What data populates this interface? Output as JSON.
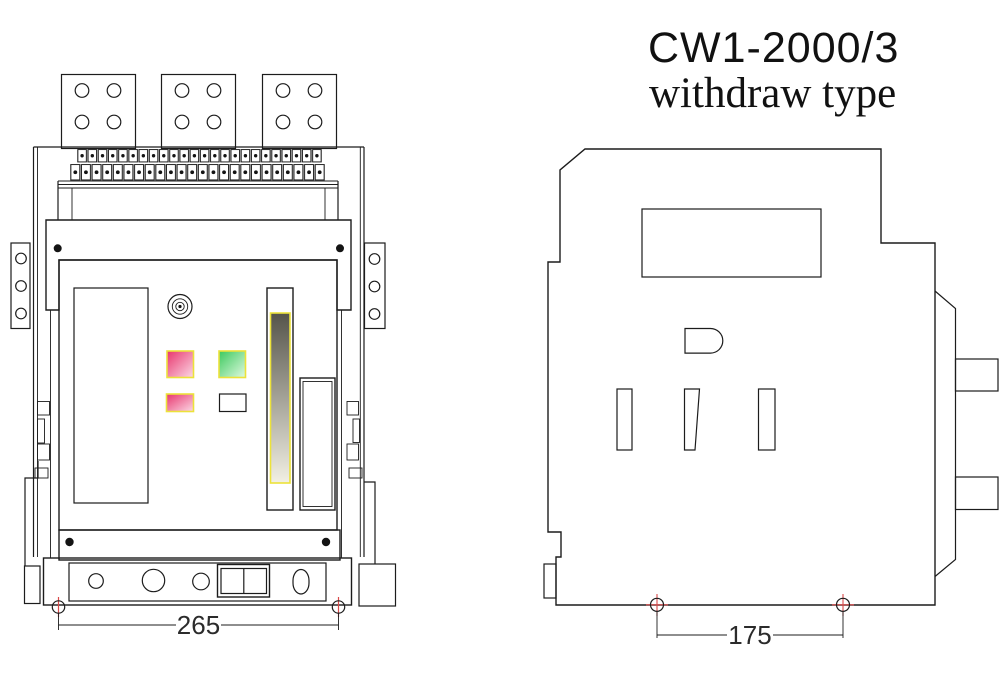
{
  "title": {
    "model": "CW1-2000/3",
    "type_label": "withdraw type"
  },
  "front_view": {
    "dimension_mm": "265",
    "terminal_rows": {
      "row1_blocks": 24,
      "row2_blocks": 24
    },
    "pole_pads": 3,
    "holes_per_pad": 4,
    "bracket_holes_per_side": 3
  },
  "side_view": {
    "dimension_mm": "175",
    "slot_count": 3,
    "terminal_tabs": 2
  },
  "colors": {
    "line": "#1c1c1c",
    "datum_red": "#d94a4a",
    "indicator_border_yellow": "#ece23a",
    "pink_dark": "#e8356d",
    "pink_light": "#fbd9e6",
    "green_dark": "#3cc95e",
    "green_light": "#e0fae0",
    "slider_dark": "#55544a",
    "slider_light": "#f2f0e4",
    "strip_backing": "#a8a8a8"
  }
}
